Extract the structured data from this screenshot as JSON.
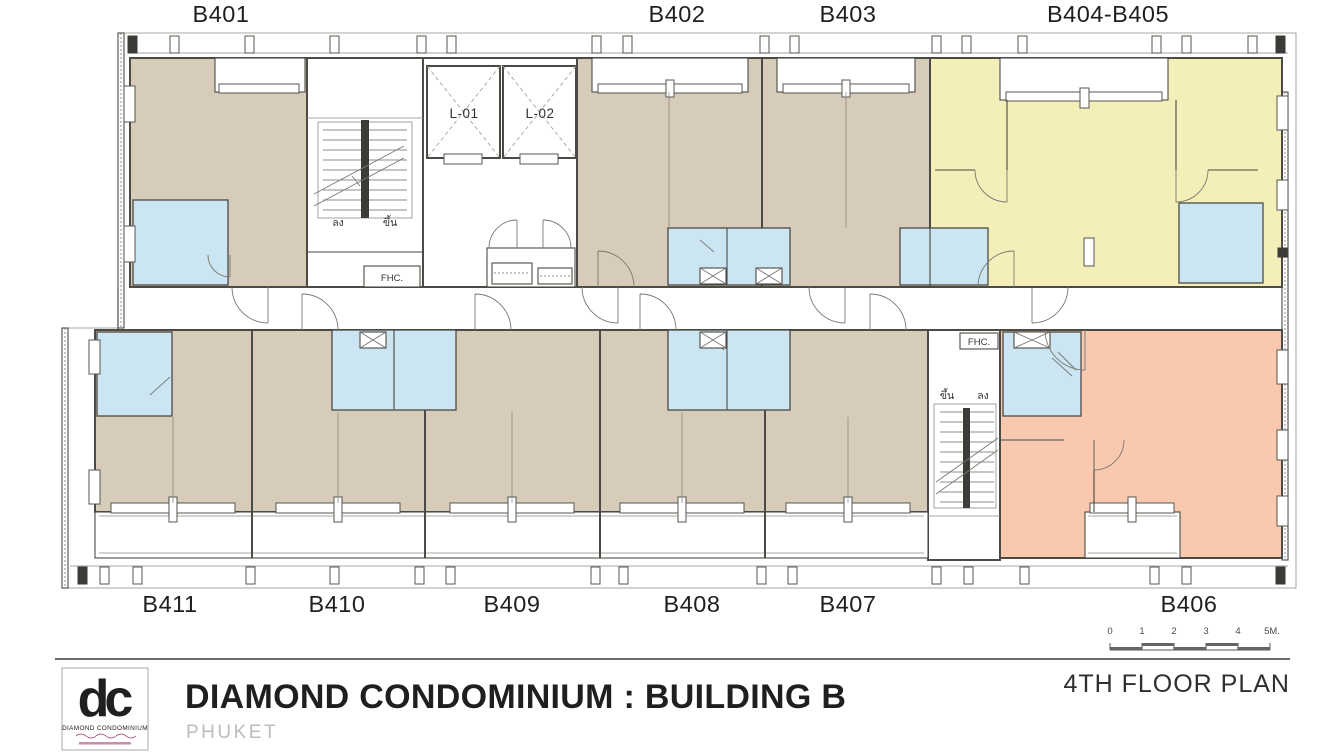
{
  "plan": {
    "units_top": [
      "B401",
      "B402",
      "B403",
      "B404-B405"
    ],
    "units_bottom": [
      "B411",
      "B410",
      "B409",
      "B408",
      "B407",
      "B406"
    ],
    "elevators": [
      "L-01",
      "L-02"
    ],
    "fhc_label": "FHC.",
    "stairs": {
      "up": "ขึ้น",
      "down": "ลง"
    },
    "colors": {
      "unit": "#d7cbb9",
      "bathroom": "#cbe5f2",
      "unit_b404_b405": "#f4efb8",
      "unit_b406": "#f8c9ae",
      "wall": "#4b4a45"
    }
  },
  "title_block": {
    "logo": {
      "monogram": "dc",
      "name": "DIAMOND CONDOMINIUM",
      "color": "#9c2f67"
    },
    "project_title": "DIAMOND CONDOMINIUM : BUILDING B",
    "location": "PHUKET",
    "plan_title": "4TH FLOOR PLAN",
    "scale_bar": {
      "ticks": [
        "0",
        "1",
        "2",
        "3",
        "4"
      ],
      "end_label": "5M."
    }
  }
}
